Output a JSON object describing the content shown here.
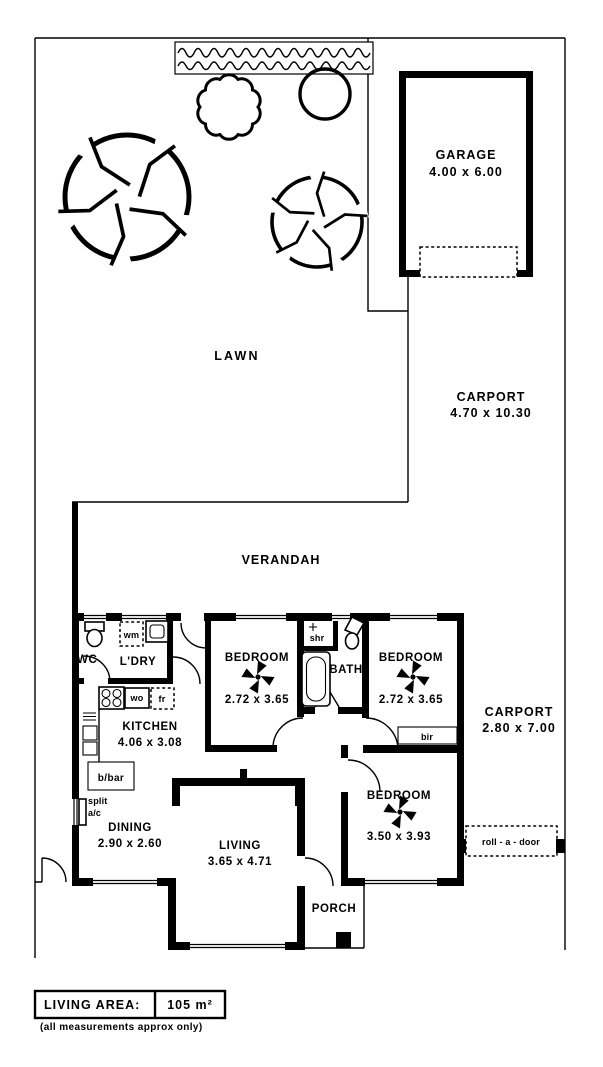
{
  "site": {
    "lawn_label": "LAWN",
    "verandah_label": "VERANDAH",
    "garage": {
      "label": "GARAGE",
      "dims": "4.00 x 6.00"
    },
    "carport_rear": {
      "label": "CARPORT",
      "dims": "4.70 x 10.30"
    },
    "carport_side": {
      "label": "CARPORT",
      "dims": "2.80 x 7.00"
    },
    "roll_a_door_label": "roll - a - door"
  },
  "rooms": {
    "bedroom1": {
      "label": "BEDROOM",
      "dims": "2.72 x 3.65"
    },
    "bedroom2": {
      "label": "BEDROOM",
      "dims": "2.72 x 3.65"
    },
    "bedroom3": {
      "label": "BEDROOM",
      "dims": "3.50 x 3.93"
    },
    "kitchen": {
      "label": "KITCHEN",
      "dims": "4.06 x 3.08"
    },
    "dining": {
      "label": "DINING",
      "dims": "2.90 x 2.60"
    },
    "living": {
      "label": "LIVING",
      "dims": "3.65 x 4.71"
    },
    "bath_label": "BATH",
    "wc_label": "WC",
    "laundry_label": "L'DRY",
    "porch_label": "PORCH"
  },
  "fixtures": {
    "shower_label": "shr",
    "washing_machine_label": "wm",
    "wall_oven_label": "wo",
    "fridge_label": "fr",
    "breakfast_bar_label": "b/bar",
    "built_in_robe_label": "bir",
    "split_label": "split",
    "ac_label": "a/c"
  },
  "legend": {
    "living_area_label": "LIVING AREA:",
    "living_area_value": "105 m²",
    "note": "(all measurements approx only)"
  }
}
